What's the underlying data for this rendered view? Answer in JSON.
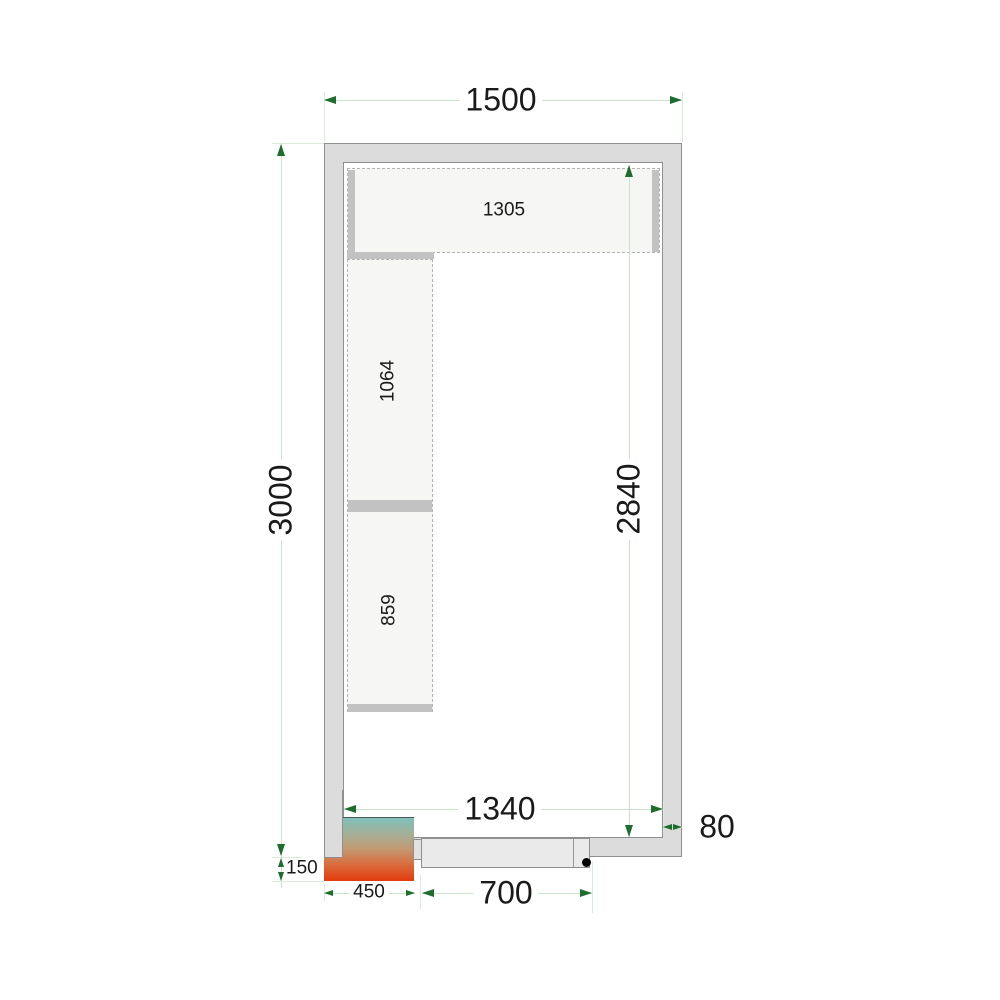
{
  "diagram": {
    "title": "cold-room-floor-plan",
    "dimensions": {
      "overall_width": "1500",
      "overall_depth": "3000",
      "inner_depth": "2840",
      "inner_width": "1340",
      "door_width": "700",
      "cooling_unit_width": "450",
      "cooling_unit_protrusion": "150",
      "wall_thickness": "80"
    },
    "shelving": {
      "top_run_length": "1305",
      "left_upper_run_length": "1064",
      "left_lower_run_length": "859"
    },
    "colors": {
      "wall_fill": "#dcdcdc",
      "wall_outline": "#8f8f8f",
      "shelf_fill": "#f6f6f4",
      "shelf_border": "#b3b3b3",
      "dimension_line": "#c9e4ca",
      "extension_line": "#d9edda",
      "arrow_green": "#1d6d2d",
      "text": "#1a1a1a",
      "heatmap_top": "#7fc1bb",
      "heatmap_bottom": "#e23a0e",
      "door_fill": "#eaeaea",
      "door_handle": "#000000"
    }
  }
}
